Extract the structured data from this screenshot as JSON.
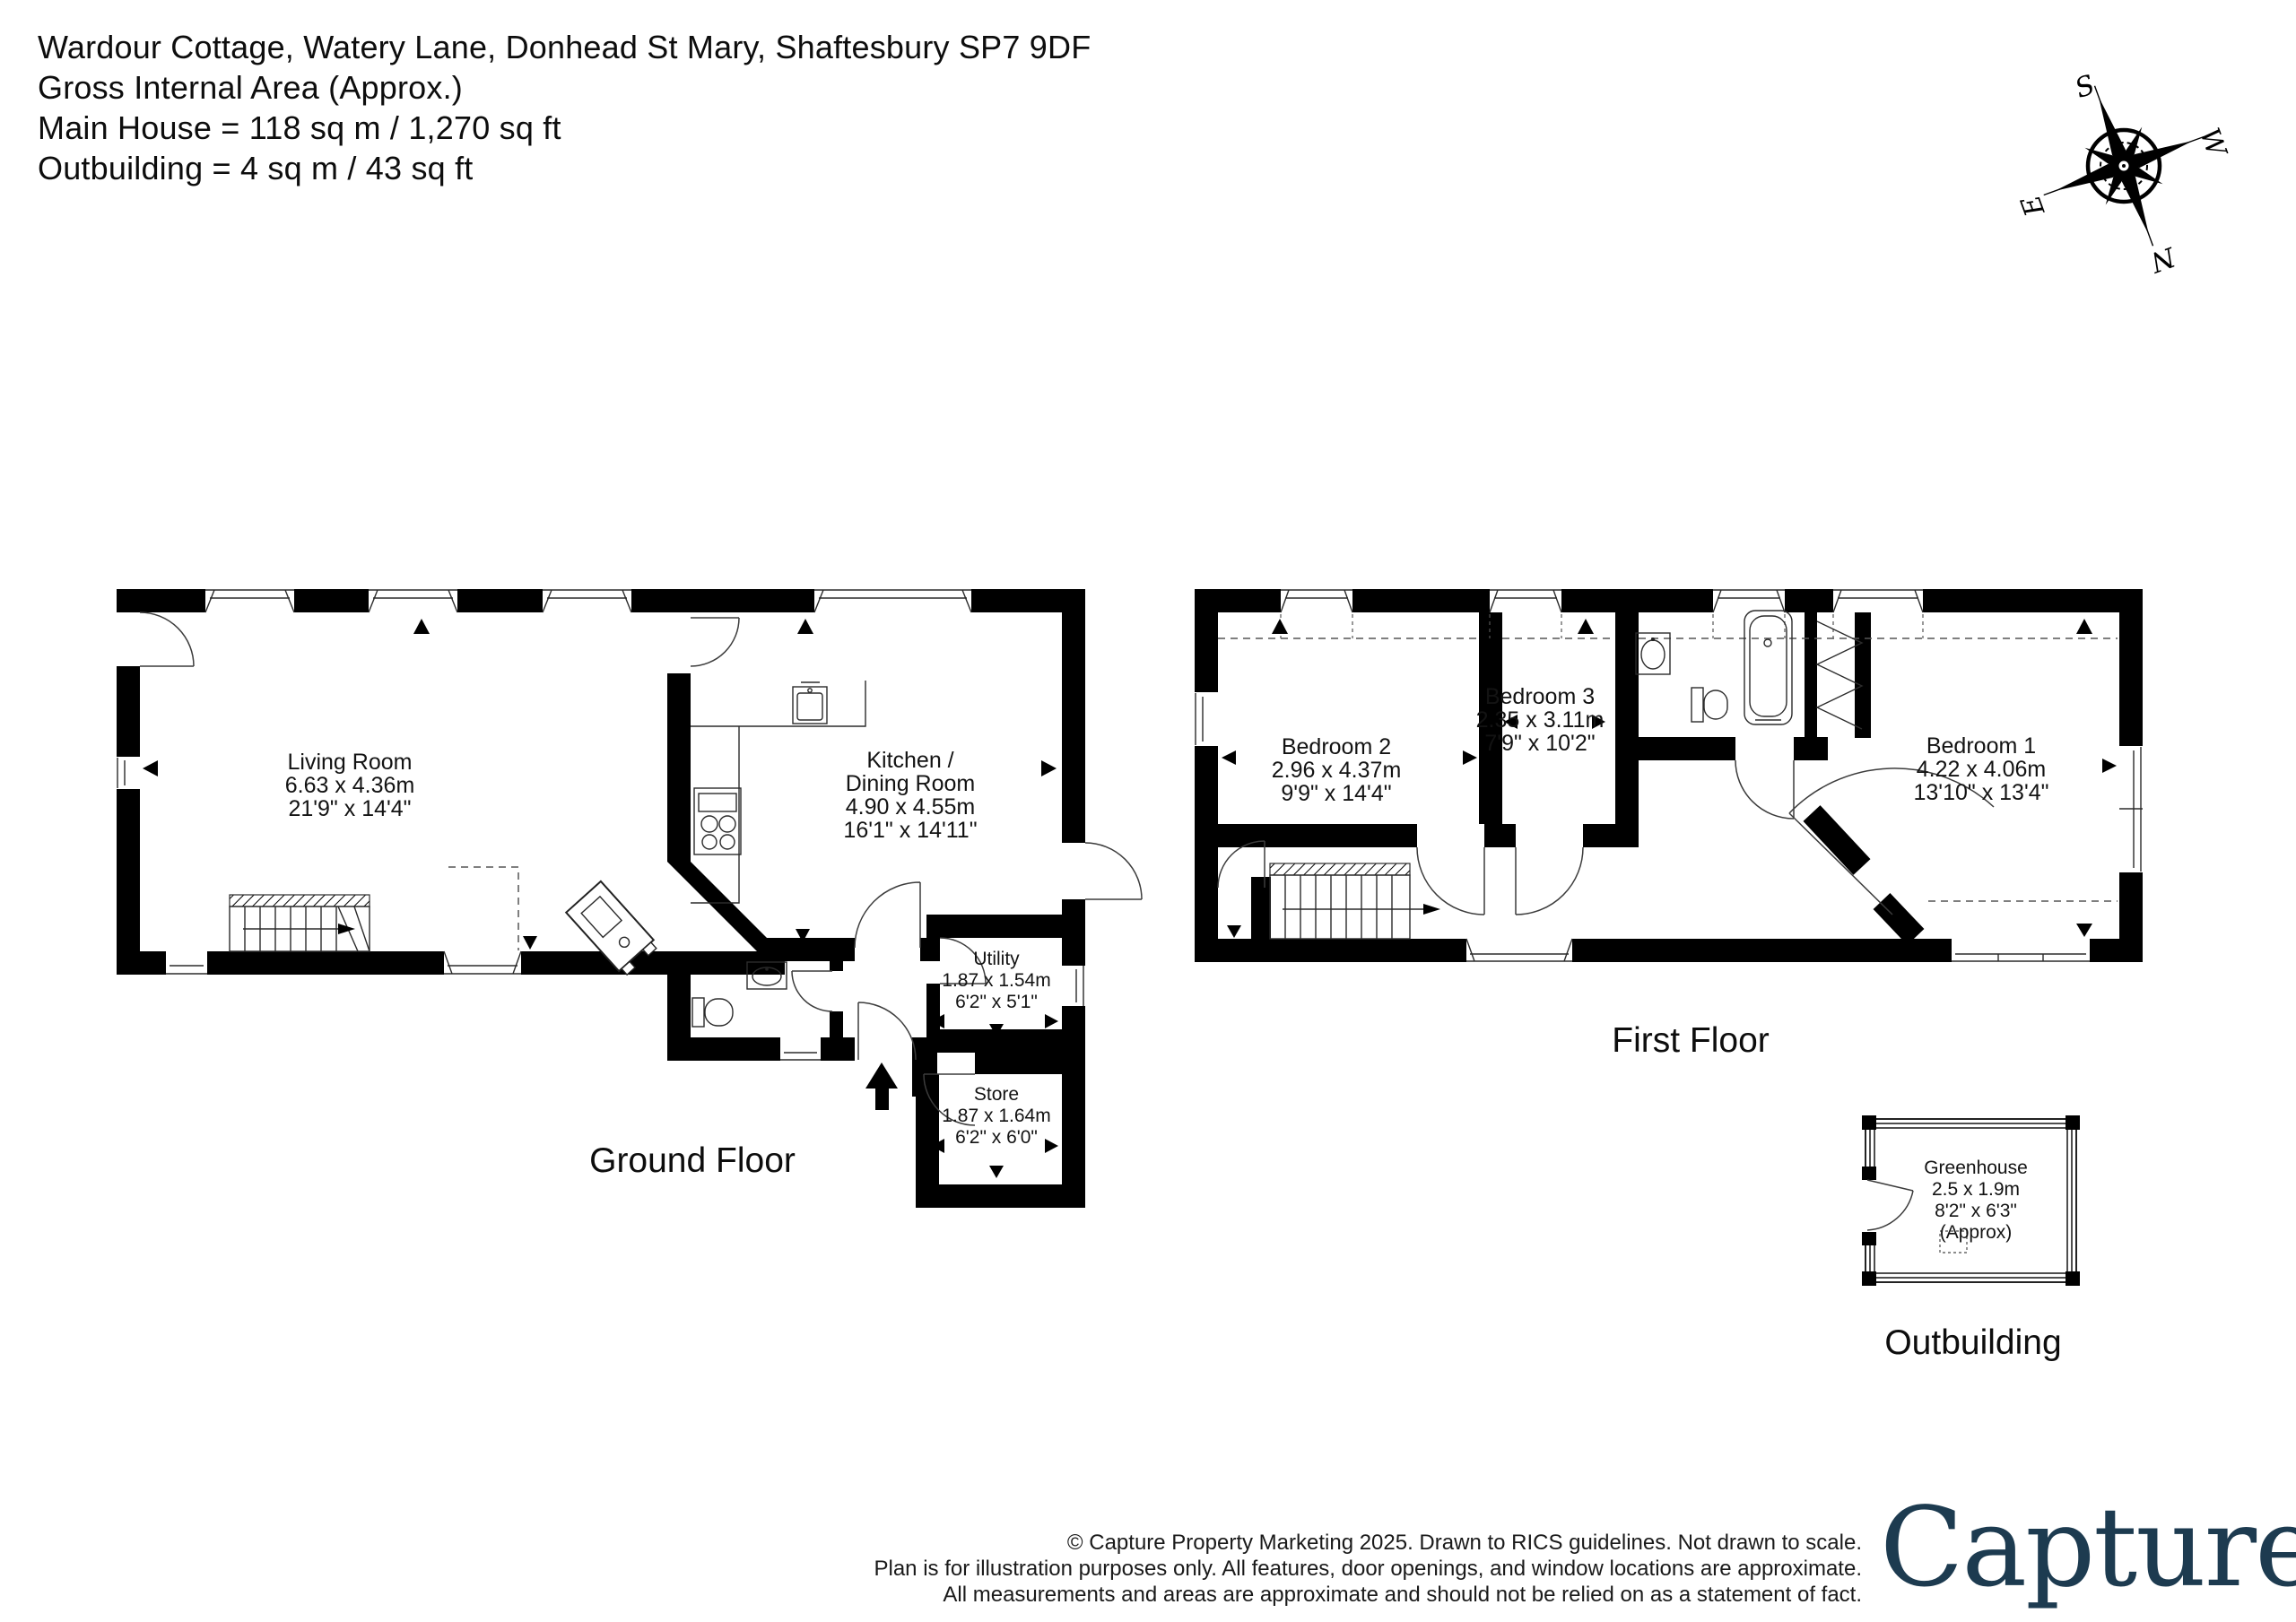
{
  "header": {
    "line1": "Wardour Cottage, Watery Lane, Donhead St Mary, Shaftesbury  SP7 9DF",
    "line2": "Gross Internal Area (Approx.)",
    "line3": "Main House = 118 sq m / 1,270 sq ft",
    "line4": "Outbuilding = 4 sq m / 43 sq ft"
  },
  "compass": {
    "n": "N",
    "s": "S",
    "e": "E",
    "w": "W"
  },
  "floors": {
    "ground": {
      "title": "Ground Floor",
      "rooms": {
        "living": {
          "name": "Living Room",
          "metric": "6.63 x 4.36m",
          "imperial": "21'9\" x 14'4\""
        },
        "kitchen": {
          "name": "Kitchen /",
          "name2": "Dining Room",
          "metric": "4.90 x 4.55m",
          "imperial": "16'1\" x 14'11\""
        },
        "utility": {
          "name": "Utility",
          "metric": "1.87 x 1.54m",
          "imperial": "6'2\" x 5'1\""
        },
        "store": {
          "name": "Store",
          "metric": "1.87 x 1.64m",
          "imperial": "6'2\" x 6'0\""
        }
      }
    },
    "first": {
      "title": "First Floor",
      "rooms": {
        "bedroom1": {
          "name": "Bedroom 1",
          "metric": "4.22 x 4.06m",
          "imperial": "13'10\" x 13'4\""
        },
        "bedroom2": {
          "name": "Bedroom 2",
          "metric": "2.96 x 4.37m",
          "imperial": "9'9\" x 14'4\""
        },
        "bedroom3": {
          "name": "Bedroom 3",
          "metric": "2.35 x 3.11m",
          "imperial": "7'9\" x 10'2\""
        }
      }
    },
    "outbuilding": {
      "title": "Outbuilding",
      "rooms": {
        "greenhouse": {
          "name": "Greenhouse",
          "metric": "2.5 x 1.9m",
          "imperial": "8'2\" x 6'3\"",
          "note": "(Approx)"
        }
      }
    }
  },
  "footer": {
    "line1": "© Capture Property Marketing 2025. Drawn to RICS guidelines.  Not drawn to scale.",
    "line2": "Plan is for illustration purposes only. All features, door openings, and window locations are approximate.",
    "line3": "All measurements and areas are approximate and should not be relied on as a statement of fact.",
    "logo_text": "Capture",
    "logo_dot": ".",
    "logo_color": "#1d3b50",
    "logo_dot_color": "#e11960"
  },
  "plan_colors": {
    "walls": "#000000",
    "background": "#ffffff"
  }
}
